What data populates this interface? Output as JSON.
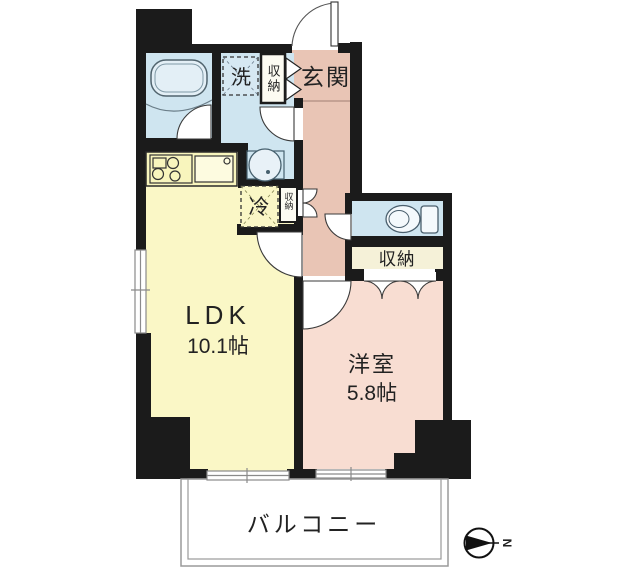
{
  "floorplan": {
    "rooms": {
      "ldk": {
        "name": "LDK",
        "size": "10.1帖"
      },
      "western": {
        "name": "洋室",
        "size": "5.8帖"
      },
      "entrance": {
        "label": "玄関"
      },
      "balcony": {
        "label": "バルコニー"
      },
      "closet_hall": {
        "label": "収納"
      },
      "closet_entrance": {
        "label": "収納"
      },
      "closet_kitchen": {
        "label": "収納"
      },
      "laundry": {
        "label": "洗"
      },
      "fridge": {
        "label": "冷"
      }
    },
    "compass": {
      "north_label": "N"
    },
    "colors": {
      "wall": "#1b1b1b",
      "water": "#cfe5f0",
      "tub": "#e3eff6",
      "ldk": "#faf7c6",
      "counter": "#f8f5bd",
      "hall": "#e9c5b5",
      "western_room": "#f8ddd2",
      "closet": "#f5f1d8"
    }
  }
}
